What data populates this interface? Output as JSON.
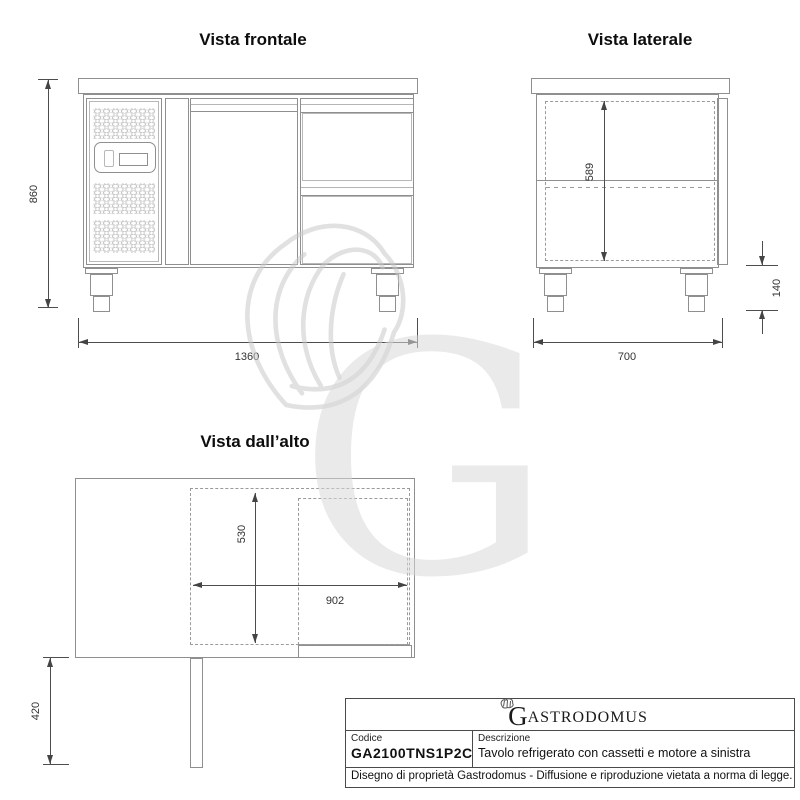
{
  "views": {
    "front": {
      "title": "Vista frontale",
      "height": "860",
      "width": "1360"
    },
    "side": {
      "title": "Vista laterale",
      "interior_height": "589",
      "leg_height": "140",
      "depth": "700"
    },
    "top": {
      "title": "Vista dall’alto",
      "interior_depth": "530",
      "interior_width": "902",
      "door_extension": "420"
    }
  },
  "title_block": {
    "brand_initial": "G",
    "brand_rest": "ASTRODOMUS",
    "code_label": "Codice",
    "code_value": "GA2100TNS1P2C",
    "description_label": "Descrizione",
    "description_value": "Tavolo refrigerato con cassetti e motore a sinistra",
    "legal": "Disegno di proprietà Gastrodomus -  Diffusione e riproduzione vietata a norma di legge."
  },
  "watermark": {
    "letter": "G"
  },
  "colors": {
    "line": "#8f8f8f",
    "dimension": "#444444",
    "text": "#111111",
    "watermark": "#dcdcdc"
  }
}
